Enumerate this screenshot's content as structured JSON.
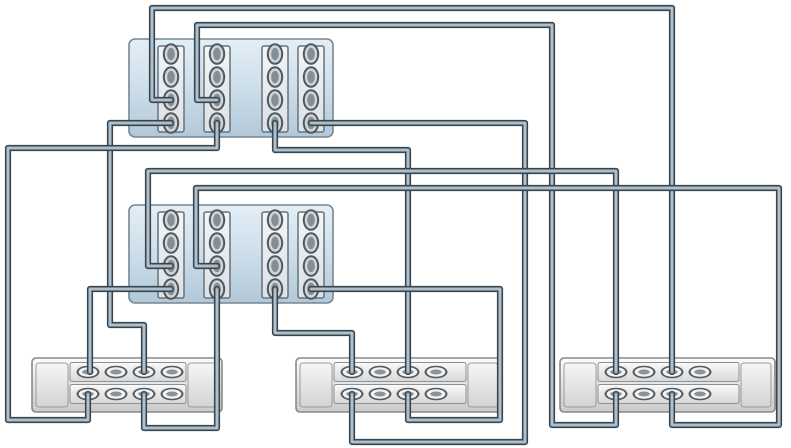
{
  "diagram": {
    "title": "storage-cabling-diagram",
    "width": 791,
    "height": 448,
    "colors": {
      "background": "#ffffff",
      "controller_fill_top": "#e4eef6",
      "controller_fill_mid": "#cfe0ec",
      "controller_fill_bottom": "#b2c8d9",
      "controller_border": "#78868f",
      "slot_fill_top": "#f3f5f6",
      "slot_fill_bottom": "#dce1e5",
      "slot_border": "#67727b",
      "ctrl_port_ring": "#4f585f",
      "ctrl_port_fill": "#cfd5d9",
      "ctrl_port_core": "#848e96",
      "shelf_fill_top": "#fbfbfb",
      "shelf_fill_bottom": "#cccccc",
      "shelf_border": "#888888",
      "cap_fill_top": "#f6f6f6",
      "cap_fill_bottom": "#d4d4d4",
      "row_fill_top": "#f9f9f9",
      "row_fill_bottom": "#d8d8d8",
      "row_border": "#8f8f8f",
      "shelf_port_ring": "#565c61",
      "shelf_port_fill": "#f2f4f4",
      "shelf_port_core": "#8d9398",
      "cable_outline": "#3a444c",
      "cable_core": "#8095a5",
      "cable_highlight": "#ccd7df"
    },
    "controllers": [
      {
        "id": "controller-1",
        "x": 129,
        "y": 39,
        "w": 204,
        "h": 98
      },
      {
        "id": "controller-2",
        "x": 129,
        "y": 205,
        "w": 204,
        "h": 98
      }
    ],
    "slot_offsets_x": [
      29,
      75,
      133,
      169
    ],
    "slot": {
      "w": 26,
      "y_offset": 7,
      "h": 86
    },
    "port_offsets_y": [
      15,
      38,
      61,
      84
    ],
    "shelves": [
      {
        "id": "disk-shelf-1",
        "x": 32,
        "y": 358,
        "w": 190,
        "h": 54
      },
      {
        "id": "disk-shelf-2",
        "x": 296,
        "y": 358,
        "w": 206,
        "h": 54
      },
      {
        "id": "disk-shelf-3",
        "x": 560,
        "y": 358,
        "w": 215,
        "h": 54
      }
    ],
    "shelf_port_offsets_x": [
      56,
      84,
      112,
      140
    ],
    "shelf_row_offsets_y": [
      14,
      36
    ],
    "cables": [
      {
        "id": "cable-1",
        "from": "controller-1 slot-1 port-3",
        "to": "disk-shelf-3 top-port-3",
        "points": [
          [
            171,
            100
          ],
          [
            152,
            100
          ],
          [
            152,
            8
          ],
          [
            672,
            8
          ],
          [
            672,
            372
          ]
        ]
      },
      {
        "id": "cable-2",
        "from": "controller-1 slot-2 port-3",
        "to": "disk-shelf-3 bottom-port-1",
        "points": [
          [
            217,
            100
          ],
          [
            197,
            100
          ],
          [
            197,
            25
          ],
          [
            552,
            25
          ],
          [
            552,
            425
          ],
          [
            616,
            425
          ],
          [
            616,
            394
          ]
        ]
      },
      {
        "id": "cable-3",
        "from": "controller-1 slot-1 port-4",
        "to": "disk-shelf-1 top-port-3",
        "points": [
          [
            171,
            123
          ],
          [
            110,
            123
          ],
          [
            110,
            325
          ],
          [
            144,
            325
          ],
          [
            144,
            372
          ]
        ]
      },
      {
        "id": "cable-4",
        "from": "controller-1 slot-2 port-4",
        "to": "disk-shelf-1 bottom-port-1",
        "points": [
          [
            217,
            123
          ],
          [
            217,
            148
          ],
          [
            8,
            148
          ],
          [
            8,
            420
          ],
          [
            88,
            420
          ],
          [
            88,
            394
          ]
        ]
      },
      {
        "id": "cable-5",
        "from": "controller-1 slot-3 port-4",
        "to": "disk-shelf-2 top-port-3",
        "points": [
          [
            275,
            123
          ],
          [
            275,
            150
          ],
          [
            408,
            150
          ],
          [
            408,
            372
          ]
        ]
      },
      {
        "id": "cable-6",
        "from": "controller-1 slot-4 port-4",
        "to": "disk-shelf-2 bottom-port-1",
        "points": [
          [
            311,
            123
          ],
          [
            525,
            123
          ],
          [
            525,
            442
          ],
          [
            352,
            442
          ],
          [
            352,
            394
          ]
        ]
      },
      {
        "id": "cable-7",
        "from": "controller-2 slot-1 port-3",
        "to": "disk-shelf-3 top-port-1",
        "points": [
          [
            171,
            266
          ],
          [
            148,
            266
          ],
          [
            148,
            171
          ],
          [
            616,
            171
          ],
          [
            616,
            372
          ]
        ]
      },
      {
        "id": "cable-8",
        "from": "controller-2 slot-2 port-3",
        "to": "disk-shelf-3 bottom-port-3",
        "points": [
          [
            217,
            266
          ],
          [
            196,
            266
          ],
          [
            196,
            188
          ],
          [
            779,
            188
          ],
          [
            779,
            425
          ],
          [
            672,
            425
          ],
          [
            672,
            394
          ]
        ]
      },
      {
        "id": "cable-9",
        "from": "controller-2 slot-1 port-4",
        "to": "disk-shelf-1 top-port-1",
        "points": [
          [
            171,
            289
          ],
          [
            90,
            289
          ],
          [
            90,
            372
          ]
        ]
      },
      {
        "id": "cable-10",
        "from": "controller-2 slot-2 port-4",
        "to": "disk-shelf-1 bottom-port-3",
        "points": [
          [
            217,
            289
          ],
          [
            217,
            428
          ],
          [
            144,
            428
          ],
          [
            144,
            394
          ]
        ]
      },
      {
        "id": "cable-11",
        "from": "controller-2 slot-3 port-4",
        "to": "disk-shelf-2 top-port-1",
        "points": [
          [
            275,
            289
          ],
          [
            275,
            333
          ],
          [
            352,
            333
          ],
          [
            352,
            372
          ]
        ]
      },
      {
        "id": "cable-12",
        "from": "controller-2 slot-4 port-4",
        "to": "disk-shelf-2 bottom-port-3",
        "points": [
          [
            311,
            289
          ],
          [
            500,
            289
          ],
          [
            500,
            420
          ],
          [
            408,
            420
          ],
          [
            408,
            394
          ]
        ]
      }
    ]
  }
}
